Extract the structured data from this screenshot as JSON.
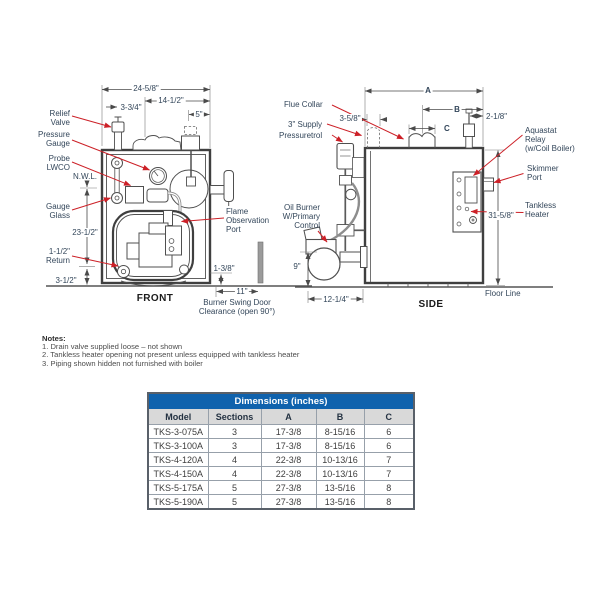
{
  "front": {
    "title": "FRONT",
    "labels": {
      "relief_valve": "Relief\nValve",
      "pressure_gauge": "Pressure\nGauge",
      "probe_lwco": "Probe\nLWCO",
      "nwl": "N.W.L.",
      "gauge_glass": "Gauge\nGlass",
      "return": "1-1/2\"\nReturn",
      "flame_port": "Flame\nObservation\nPort",
      "swing_door": "Burner Swing Door\nClearance (open 90°)"
    },
    "dims": {
      "width": "24-5/8\"",
      "flue_offset": "14-1/2\"",
      "valve_offset": "3-3/4\"",
      "tap": "5\"",
      "nwl_height": "23-1/2\"",
      "return_height": "3-1/2\"",
      "base_gap": "1-3/8\"",
      "door_clearance": "11\""
    }
  },
  "side": {
    "title": "SIDE",
    "labels": {
      "flue_collar": "Flue Collar",
      "supply": "3\" Supply",
      "pressuretrol": "Pressuretrol",
      "oil_burner": "Oil Burner\nW/Primary\nControl",
      "aquastat": "Aquastat\nRelay\n(w/Coil Boiler)",
      "skimmer": "Skimmer\nPort",
      "tankless": "Tankless\nHeater",
      "floor_line": "Floor Line"
    },
    "dims": {
      "a": "A",
      "b": "B",
      "c": "C",
      "supply_offset": "3-5/8\"",
      "valve_offset": "2-1/8\"",
      "height": "31-5/8\"",
      "burner_height": "9\"",
      "burner_depth": "12-1/4\""
    }
  },
  "notes": {
    "heading": "Notes:",
    "items": [
      "1. Drain valve supplied loose – not shown",
      "2. Tankless heater opening not present unless equipped with tankless heater",
      "3. Piping shown hidden not furnished with boiler"
    ]
  },
  "table": {
    "title": "Dimensions (inches)",
    "headers": [
      "Model",
      "Sections",
      "A",
      "B",
      "C"
    ],
    "rows": [
      [
        "TKS-3-075A",
        "3",
        "17-3/8",
        "8-15/16",
        "6"
      ],
      [
        "TKS-3-100A",
        "3",
        "17-3/8",
        "8-15/16",
        "6"
      ],
      [
        "TKS-4-120A",
        "4",
        "22-3/8",
        "10-13/16",
        "7"
      ],
      [
        "TKS-4-150A",
        "4",
        "22-3/8",
        "10-13/16",
        "7"
      ],
      [
        "TKS-5-175A",
        "5",
        "27-3/8",
        "13-5/16",
        "8"
      ],
      [
        "TKS-5-190A",
        "5",
        "27-3/8",
        "13-5/16",
        "8"
      ]
    ]
  },
  "colors": {
    "leader_red": "#cc2027",
    "table_header_blue": "#0f62ad",
    "drawing_line": "#3f3f3f"
  }
}
